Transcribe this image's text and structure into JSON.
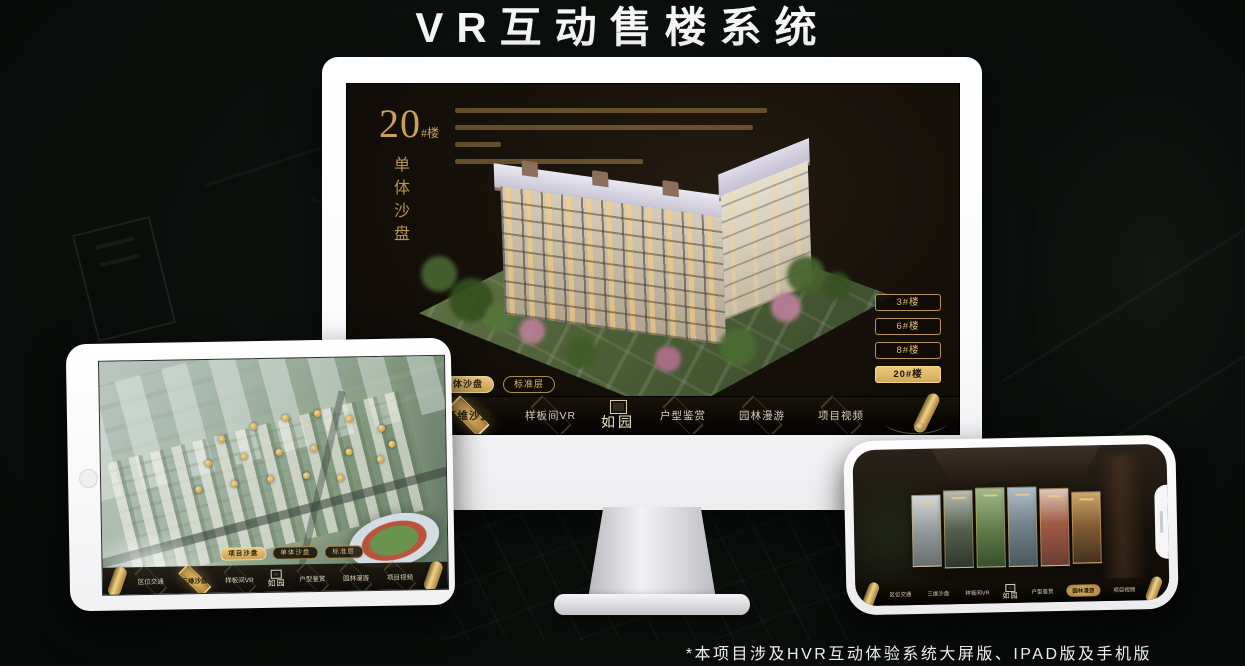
{
  "header": {
    "title": "VR互动售楼系统"
  },
  "footer": {
    "note": "*本项目涉及HVR互动体验系统大屏版、IPAD版及手机版"
  },
  "suite": {
    "logo": "如园",
    "tabs": [
      "项目沙盘",
      "单体沙盘",
      "标准层"
    ],
    "nav_items": [
      "区位交通",
      "三维沙盘",
      "样板间VR",
      "户型鉴赏",
      "园林漫游",
      "项目视频"
    ]
  },
  "desktop": {
    "block_number": "20",
    "block_unit": "#楼",
    "section_title": "单体沙盘",
    "floor_buttons": [
      "3#楼",
      "6#楼",
      "8#楼",
      "20#楼"
    ],
    "active_floor": "20#楼",
    "active_tab": "单体沙盘",
    "active_nav": "三维沙盘"
  },
  "tablet": {
    "active_tab": "项目沙盘",
    "active_nav": "三维沙盘"
  },
  "phone": {
    "active_nav": "园林漫游"
  },
  "colors": {
    "gold": "#d2a964",
    "gold_bright": "#e9c87e",
    "screen_bg": "#171009",
    "page_bg": "#0a0e0b"
  }
}
